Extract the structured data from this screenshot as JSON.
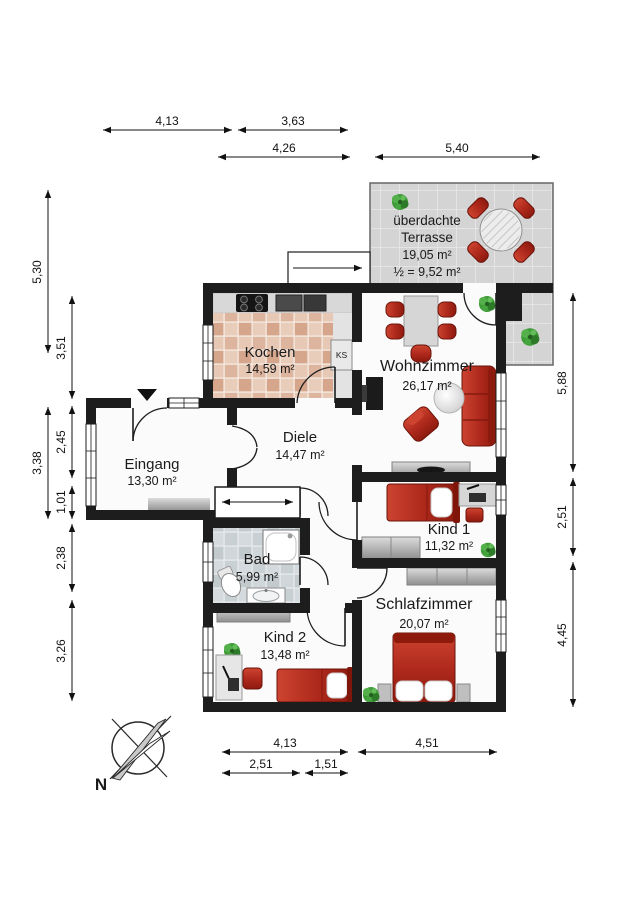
{
  "rooms": {
    "terrasse": {
      "name_line1": "überdachte",
      "name_line2": "Terrasse",
      "area": "19,05 m²",
      "area_half": "½ = 9,52 m²"
    },
    "kochen": {
      "name": "Kochen",
      "area": "14,59 m²"
    },
    "wohnzimmer": {
      "name": "Wohnzimmer",
      "area": "26,17 m²"
    },
    "diele": {
      "name": "Diele",
      "area": "14,47 m²"
    },
    "eingang": {
      "name": "Eingang",
      "area": "13,30 m²"
    },
    "kind1": {
      "name": "Kind 1",
      "area": "11,32 m²"
    },
    "bad": {
      "name": "Bad",
      "area": "5,99 m²"
    },
    "kind2": {
      "name": "Kind 2",
      "area": "13,48 m²"
    },
    "schlafzimmer": {
      "name": "Schlafzimmer",
      "area": "20,07 m²"
    }
  },
  "labels": {
    "fridge": "KS",
    "compass_north": "N"
  },
  "dimensions": {
    "top": {
      "d1": "4,13",
      "d2": "3,63",
      "d3": "4,26",
      "d4": "5,40"
    },
    "left": {
      "d1": "5,30",
      "d2": "3,51",
      "d3": "3,38",
      "d4": "2,45",
      "d5": "1,01",
      "d6": "2,38",
      "d7": "3,26"
    },
    "right": {
      "d1": "5,88",
      "d2": "2,51",
      "d3": "4,45"
    },
    "bottom": {
      "d1": "4,13",
      "d2": "4,51",
      "d3": "2,51",
      "d4": "1,51"
    }
  },
  "colors": {
    "wall": "#1d1d1d",
    "furniture_red": "#b02a1d",
    "terrace_tile": "#d4d4d4",
    "kitchen_tile": "#e0b7a2",
    "bath_tile": "#ccd3d7",
    "plant_green": "#3f9b38",
    "counter_gray": "#d8d8d8"
  }
}
